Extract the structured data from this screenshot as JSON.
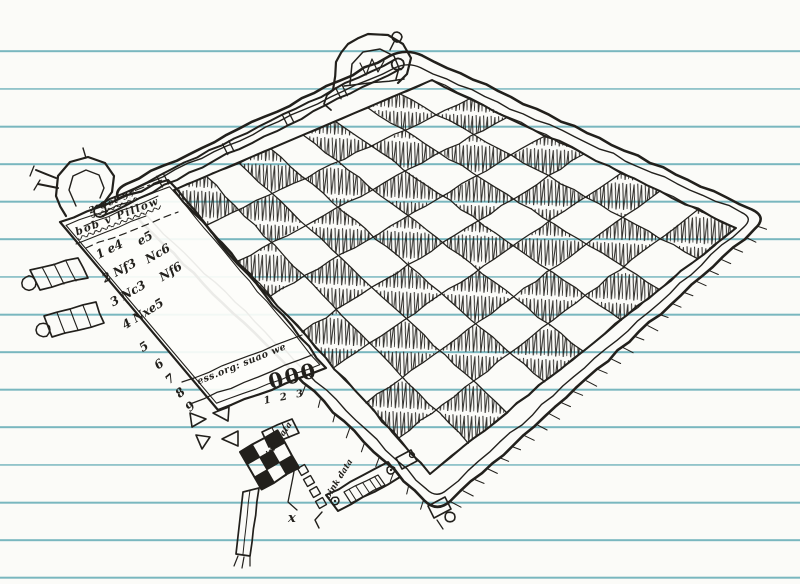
{
  "scene": {
    "ink_color": "#22201c",
    "paper_color": "#fbfbf8",
    "rule_line_color": "#79b7bf",
    "board": {
      "rows": 8,
      "cols": 8,
      "dark_square_style": "scribble-hatch"
    }
  },
  "scoresheet": {
    "date": "2 Oct 97",
    "players": "bob v Pillow",
    "rows": [
      {
        "num": "1",
        "white": "e4",
        "black": "e5"
      },
      {
        "num": "2",
        "white": "Nf3",
        "black": "Nc6"
      },
      {
        "num": "3",
        "white": "Nc3",
        "black": "Nf6"
      },
      {
        "num": "4",
        "white": "Nxe5",
        "black": ""
      },
      {
        "num": "5",
        "white": "",
        "black": ""
      },
      {
        "num": "6",
        "white": "",
        "black": ""
      },
      {
        "num": "7",
        "white": "",
        "black": ""
      },
      {
        "num": "8",
        "white": "",
        "black": ""
      },
      {
        "num": "9",
        "white": "",
        "black": ""
      }
    ]
  },
  "doodles": {
    "edge_label": "ess.org: suao we",
    "zeros": "000",
    "digits": "1 2 3",
    "corner_label_a": "oink data",
    "corner_label_b": "oink data",
    "strap_mark": "x"
  }
}
